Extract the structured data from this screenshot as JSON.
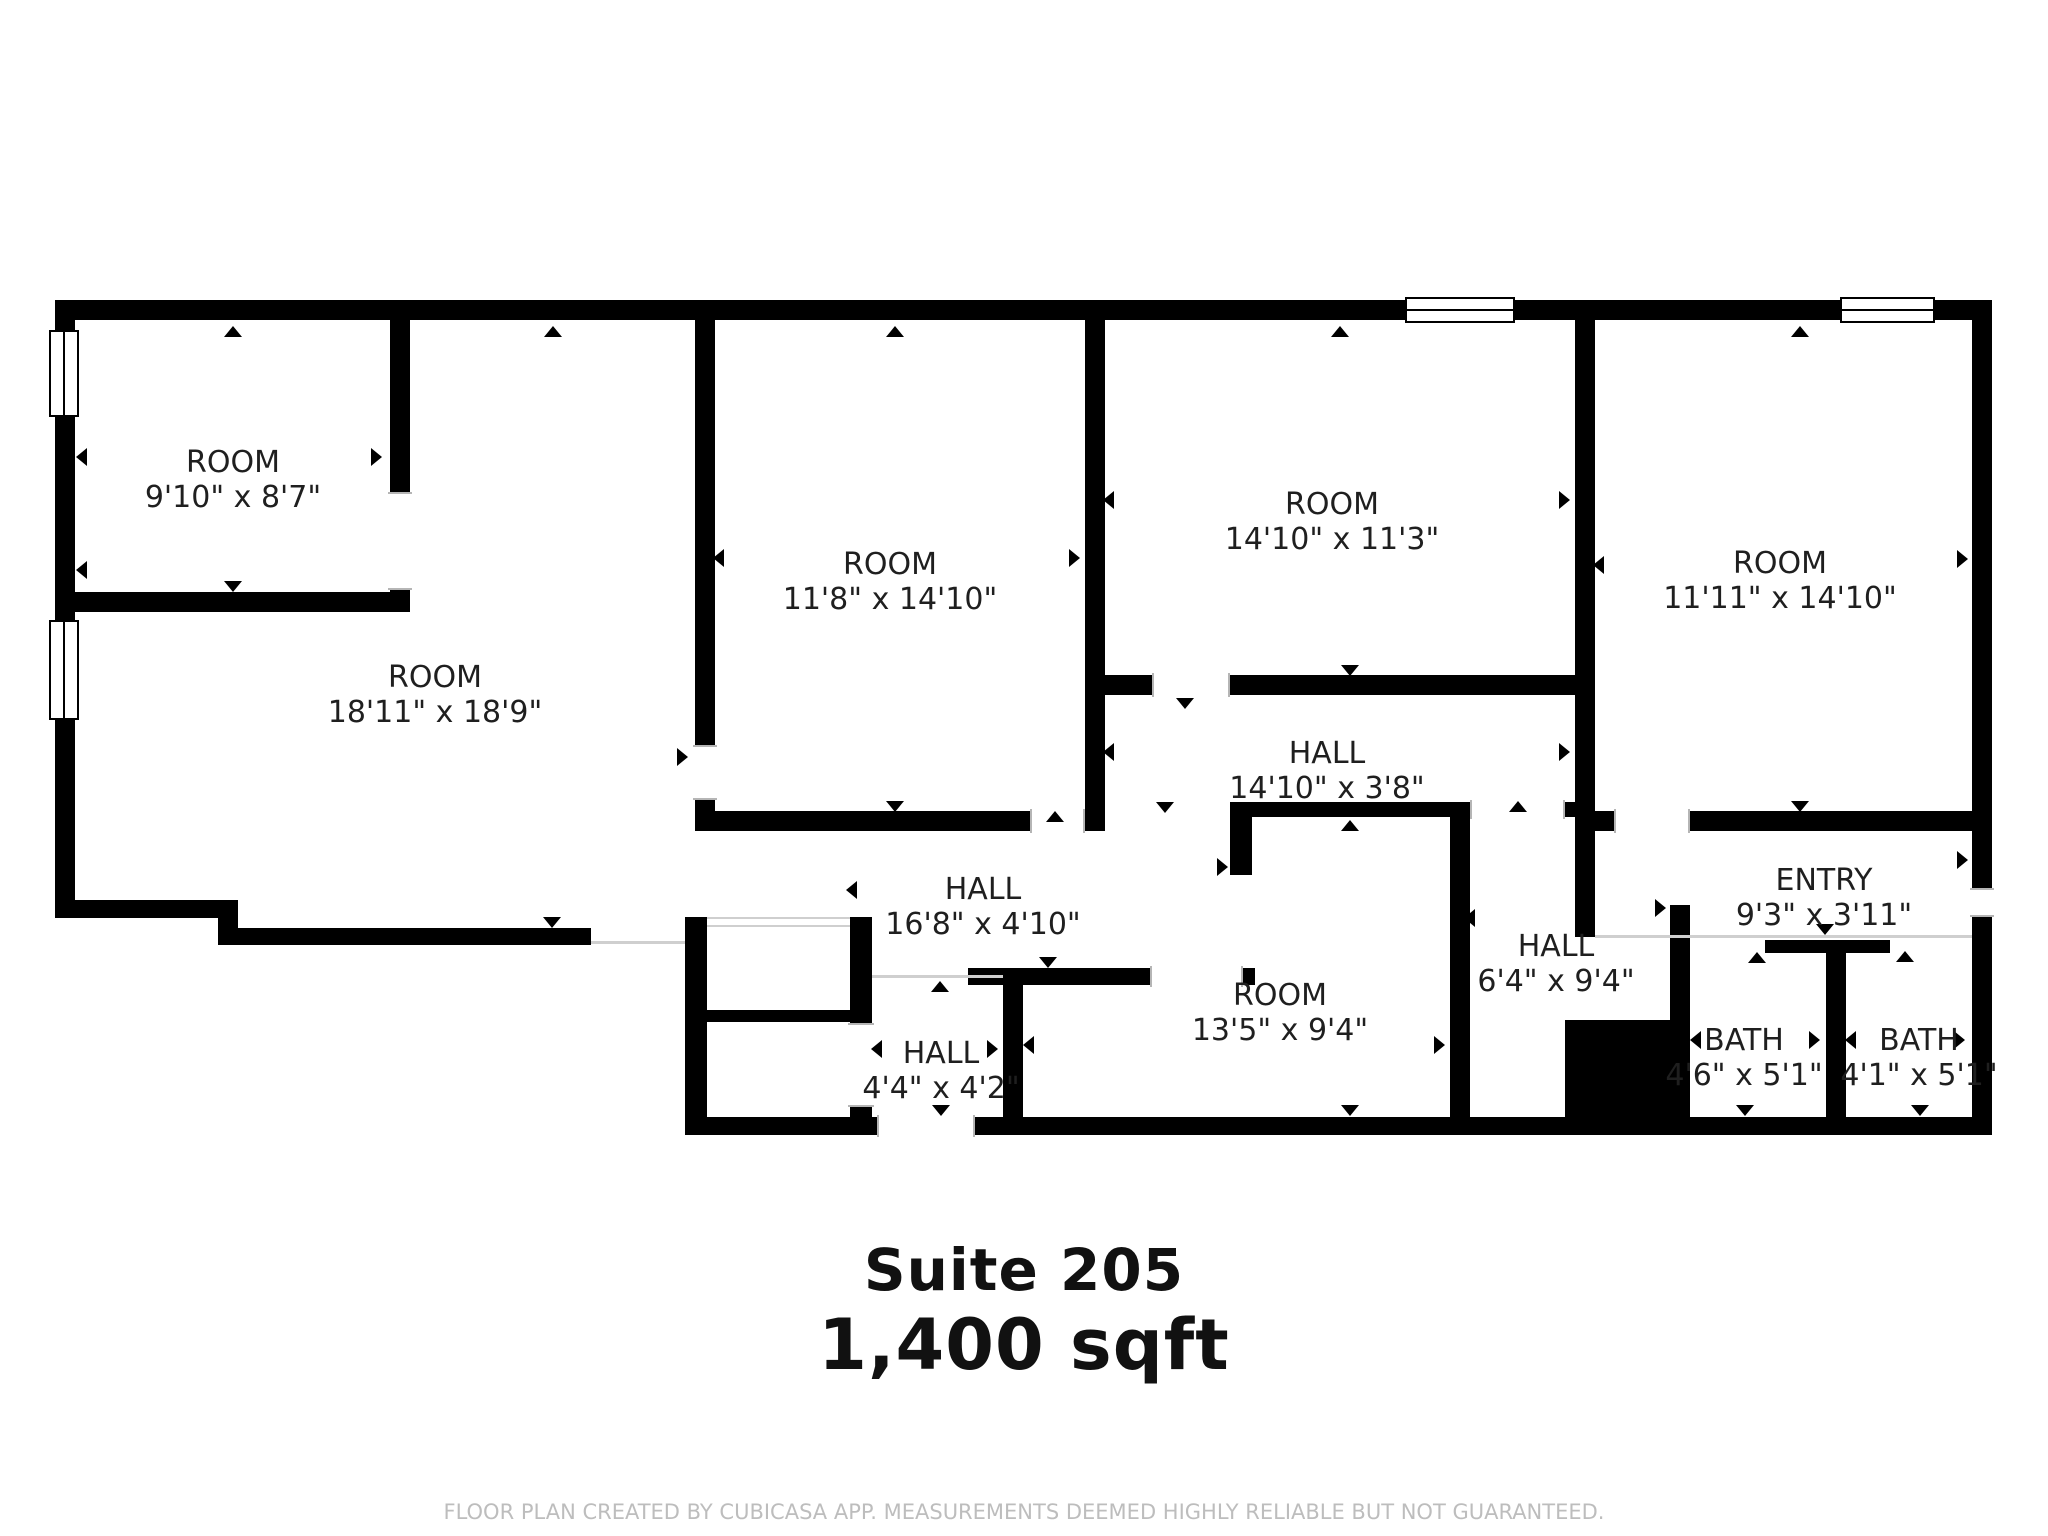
{
  "meta": {
    "title": "Suite 205",
    "area": "1,400 sqft",
    "disclaimer": "FLOOR PLAN CREATED BY CUBICASA APP. MEASUREMENTS DEEMED HIGHLY RELIABLE BUT NOT GUARANTEED."
  },
  "colors": {
    "wall": "#000000",
    "background": "#ffffff",
    "open_boundary": "#cfcfcf",
    "door_jamb": "#b5b5b5",
    "label_text": "#1f1f1f",
    "disclaimer_text": "#bdbdbd"
  },
  "rooms": [
    {
      "name": "ROOM",
      "dims": "9'10\" x 8'7\"",
      "cx": 233,
      "cy": 480
    },
    {
      "name": "ROOM",
      "dims": "18'11\" x 18'9\"",
      "cx": 435,
      "cy": 695
    },
    {
      "name": "ROOM",
      "dims": "11'8\" x 14'10\"",
      "cx": 890,
      "cy": 582
    },
    {
      "name": "ROOM",
      "dims": "14'10\" x 11'3\"",
      "cx": 1332,
      "cy": 522
    },
    {
      "name": "ROOM",
      "dims": "11'11\" x 14'10\"",
      "cx": 1780,
      "cy": 581
    },
    {
      "name": "HALL",
      "dims": "14'10\" x 3'8\"",
      "cx": 1327,
      "cy": 771
    },
    {
      "name": "HALL",
      "dims": "16'8\" x 4'10\"",
      "cx": 983,
      "cy": 907
    },
    {
      "name": "HALL",
      "dims": "4'4\" x 4'2\"",
      "cx": 941,
      "cy": 1071
    },
    {
      "name": "ROOM",
      "dims": "13'5\" x 9'4\"",
      "cx": 1280,
      "cy": 1013
    },
    {
      "name": "HALL",
      "dims": "6'4\" x 9'4\"",
      "cx": 1556,
      "cy": 964
    },
    {
      "name": "ENTRY",
      "dims": "9'3\" x 3'11\"",
      "cx": 1824,
      "cy": 898
    },
    {
      "name": "BATH",
      "dims": "4'6\" x 5'1\"",
      "cx": 1744,
      "cy": 1058
    },
    {
      "name": "BATH",
      "dims": "4'1\" x 5'1\"",
      "cx": 1919,
      "cy": 1058
    }
  ],
  "plan": {
    "walls": [
      [
        55,
        300,
        1937,
        20
      ],
      [
        55,
        300,
        20,
        618
      ],
      [
        1972,
        300,
        20,
        588
      ],
      [
        1972,
        917,
        20,
        218
      ],
      [
        55,
        900,
        183,
        18
      ],
      [
        218,
        900,
        20,
        45
      ],
      [
        218,
        928,
        373,
        17
      ],
      [
        390,
        320,
        20,
        172
      ],
      [
        390,
        590,
        20,
        22
      ],
      [
        55,
        592,
        355,
        20
      ],
      [
        695,
        320,
        20,
        425
      ],
      [
        695,
        800,
        20,
        31
      ],
      [
        1085,
        320,
        20,
        511
      ],
      [
        695,
        811,
        335,
        20
      ],
      [
        1575,
        320,
        20,
        617
      ],
      [
        1105,
        675,
        47,
        20
      ],
      [
        1230,
        675,
        345,
        20
      ],
      [
        1595,
        811,
        19,
        20
      ],
      [
        1690,
        811,
        282,
        20
      ],
      [
        1230,
        802,
        220,
        15
      ],
      [
        1565,
        802,
        10,
        15
      ],
      [
        1450,
        802,
        20,
        315
      ],
      [
        1230,
        802,
        22,
        73
      ],
      [
        968,
        968,
        182,
        17
      ],
      [
        1240,
        968,
        15,
        17
      ],
      [
        1003,
        980,
        20,
        137
      ],
      [
        685,
        917,
        22,
        218
      ],
      [
        850,
        917,
        22,
        11
      ],
      [
        685,
        1010,
        187,
        12
      ],
      [
        850,
        928,
        22,
        95
      ],
      [
        850,
        1107,
        22,
        10
      ],
      [
        685,
        1117,
        192,
        18
      ],
      [
        975,
        1117,
        1017,
        18
      ],
      [
        1670,
        905,
        20,
        212
      ],
      [
        1765,
        940,
        125,
        13
      ],
      [
        1826,
        953,
        20,
        164
      ]
    ],
    "solid_blocks": [
      [
        1565,
        1020,
        108,
        105
      ]
    ],
    "gaps_h": [
      [
        1030,
        809,
        55,
        24
      ],
      [
        1152,
        673,
        78,
        24
      ],
      [
        1614,
        809,
        76,
        24
      ],
      [
        1150,
        966,
        93,
        21
      ],
      [
        877,
        1115,
        98,
        22
      ],
      [
        1470,
        800,
        95,
        19
      ]
    ],
    "gaps_v": [
      [
        388,
        492,
        24,
        98
      ],
      [
        693,
        745,
        24,
        55
      ],
      [
        1970,
        888,
        24,
        29
      ],
      [
        848,
        1023,
        26,
        84
      ]
    ],
    "open_lines": [
      [
        591,
        941,
        94,
        3
      ],
      [
        872,
        975,
        131,
        3
      ],
      [
        1595,
        935,
        377,
        3
      ],
      [
        707,
        917,
        143,
        2
      ],
      [
        707,
        925,
        143,
        2
      ]
    ],
    "windows_v": [
      [
        49,
        330,
        30,
        87
      ],
      [
        49,
        620,
        30,
        100
      ]
    ],
    "windows_h": [
      [
        1405,
        297,
        110,
        26
      ],
      [
        1840,
        297,
        95,
        26
      ]
    ],
    "arrows": [
      {
        "x": 233,
        "y": 331,
        "dir": "up"
      },
      {
        "x": 233,
        "y": 586,
        "dir": "down"
      },
      {
        "x": 85,
        "y": 457,
        "dir": "left"
      },
      {
        "x": 380,
        "y": 457,
        "dir": "right"
      },
      {
        "x": 553,
        "y": 331,
        "dir": "up"
      },
      {
        "x": 85,
        "y": 570,
        "dir": "left"
      },
      {
        "x": 552,
        "y": 922,
        "dir": "down"
      },
      {
        "x": 686,
        "y": 757,
        "dir": "right"
      },
      {
        "x": 895,
        "y": 331,
        "dir": "up"
      },
      {
        "x": 722,
        "y": 558,
        "dir": "left"
      },
      {
        "x": 1078,
        "y": 558,
        "dir": "right"
      },
      {
        "x": 895,
        "y": 806,
        "dir": "down"
      },
      {
        "x": 1055,
        "y": 816,
        "dir": "up"
      },
      {
        "x": 1340,
        "y": 331,
        "dir": "up"
      },
      {
        "x": 1112,
        "y": 500,
        "dir": "left"
      },
      {
        "x": 1568,
        "y": 500,
        "dir": "right"
      },
      {
        "x": 1350,
        "y": 670,
        "dir": "down"
      },
      {
        "x": 1185,
        "y": 703,
        "dir": "down"
      },
      {
        "x": 1800,
        "y": 331,
        "dir": "up"
      },
      {
        "x": 1602,
        "y": 565,
        "dir": "left"
      },
      {
        "x": 1966,
        "y": 559,
        "dir": "right"
      },
      {
        "x": 1800,
        "y": 806,
        "dir": "down"
      },
      {
        "x": 1112,
        "y": 752,
        "dir": "left"
      },
      {
        "x": 1568,
        "y": 752,
        "dir": "right"
      },
      {
        "x": 1165,
        "y": 807,
        "dir": "down"
      },
      {
        "x": 1518,
        "y": 806,
        "dir": "up"
      },
      {
        "x": 855,
        "y": 890,
        "dir": "left"
      },
      {
        "x": 1226,
        "y": 867,
        "dir": "right"
      },
      {
        "x": 1048,
        "y": 962,
        "dir": "down"
      },
      {
        "x": 940,
        "y": 986,
        "dir": "up"
      },
      {
        "x": 880,
        "y": 1049,
        "dir": "left"
      },
      {
        "x": 996,
        "y": 1049,
        "dir": "right"
      },
      {
        "x": 941,
        "y": 1110,
        "dir": "down"
      },
      {
        "x": 1350,
        "y": 825,
        "dir": "up"
      },
      {
        "x": 1032,
        "y": 1045,
        "dir": "left"
      },
      {
        "x": 1443,
        "y": 1045,
        "dir": "right"
      },
      {
        "x": 1350,
        "y": 1110,
        "dir": "down"
      },
      {
        "x": 1473,
        "y": 918,
        "dir": "left"
      },
      {
        "x": 1664,
        "y": 908,
        "dir": "right"
      },
      {
        "x": 1825,
        "y": 929,
        "dir": "down"
      },
      {
        "x": 1966,
        "y": 860,
        "dir": "right"
      },
      {
        "x": 1757,
        "y": 957,
        "dir": "up"
      },
      {
        "x": 1905,
        "y": 956,
        "dir": "up"
      },
      {
        "x": 1699,
        "y": 1040,
        "dir": "left"
      },
      {
        "x": 1818,
        "y": 1040,
        "dir": "right"
      },
      {
        "x": 1745,
        "y": 1110,
        "dir": "down"
      },
      {
        "x": 1854,
        "y": 1040,
        "dir": "left"
      },
      {
        "x": 1963,
        "y": 1040,
        "dir": "right"
      },
      {
        "x": 1920,
        "y": 1110,
        "dir": "down"
      }
    ]
  }
}
